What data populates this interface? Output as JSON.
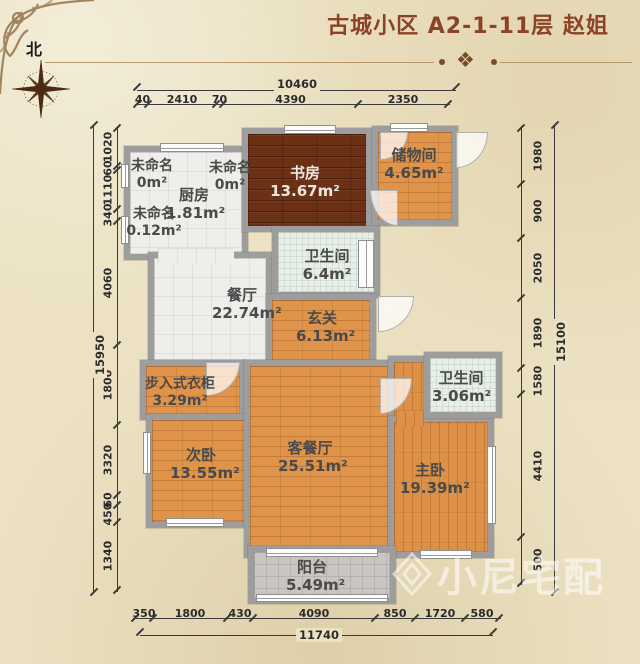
{
  "header": {
    "title": "古城小区 A2-1-11层  赵姐",
    "north_label": "北",
    "divider_ornament": "❖"
  },
  "rooms": {
    "unnamed_a": {
      "label": "未命名",
      "area": "0m²"
    },
    "unnamed_b": {
      "label": "未命名",
      "area": "0m²"
    },
    "kitchen": {
      "label": "厨房",
      "area": "1.81m²"
    },
    "unnamed_c": {
      "label": "未命名",
      "area": "0.12m²"
    },
    "study": {
      "label": "书房",
      "area": "13.67m²"
    },
    "storage": {
      "label": "储物间",
      "area": "4.65m²"
    },
    "bath1": {
      "label": "卫生间",
      "area": "6.4m²"
    },
    "dining": {
      "label": "餐厅",
      "area": "22.74m²"
    },
    "hall": {
      "label": "玄关",
      "area": "6.13m²"
    },
    "closet": {
      "label": "步入式衣柜",
      "area": "3.29m²"
    },
    "bath2": {
      "label": "卫生间",
      "area": "3.06m²"
    },
    "bedroom2": {
      "label": "次卧",
      "area": "13.55m²"
    },
    "living": {
      "label": "客餐厅",
      "area": "25.51m²"
    },
    "master": {
      "label": "主卧",
      "area": "19.39m²"
    },
    "balcony": {
      "label": "阳台",
      "area": "5.49m²"
    }
  },
  "dimensions": {
    "top": {
      "total": "10460",
      "segments": [
        "40",
        "2410",
        "70",
        "4390",
        "2350"
      ]
    },
    "bottom": {
      "total": "11740",
      "segments": [
        "350",
        "1800",
        "430",
        "4090",
        "850",
        "1720",
        "580"
      ]
    },
    "left": {
      "total": "15950",
      "segments": [
        "1020",
        "60",
        "1110",
        "340",
        "4060",
        "1800",
        "3320",
        "60",
        "450",
        "1340"
      ]
    },
    "right": {
      "total": "15100",
      "segments": [
        "1980",
        "900",
        "2050",
        "1890",
        "1580",
        "4410",
        "500"
      ]
    }
  },
  "watermark": {
    "text": "小尼宅配"
  },
  "colors": {
    "title": "#8a4326",
    "wall": "#9d9d9d",
    "dark_wood_floor": "#6c3115",
    "orange_wood_floor": "#e0944a",
    "white_tile": "#efeeeb",
    "bath_tile": "#e9efe8",
    "balcony_tile": "#c9c5c1",
    "background": "#ece2c3",
    "dimension_line": "#3a3a3a",
    "room_label": "#4a4a4a"
  }
}
